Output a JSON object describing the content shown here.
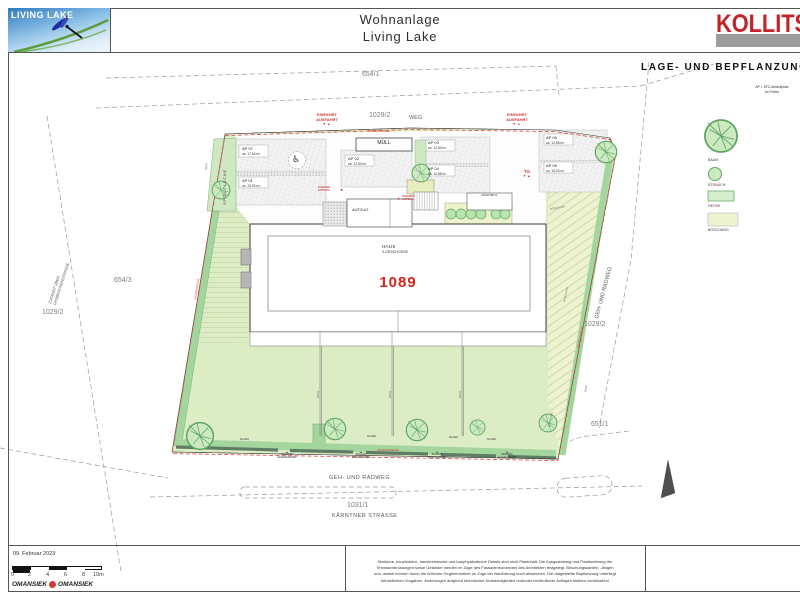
{
  "colors": {
    "accent_red": "#c62127",
    "boundary_red": "#dd4a3c",
    "lawn_green": "#dcedc6",
    "hedge_green": "#a3d69d",
    "boeschung_green": "#edf2cf"
  },
  "header": {
    "logo_text": "LIVING LAKE",
    "title_line1": "Wohnanlage",
    "title_line2": "Living Lake",
    "brand": "KOLLITSCH"
  },
  "side": {
    "plan_title": "LAGE- UND BEPFLANZUNGSPLAN",
    "ap_note_line1": "AP = KFZ-Abstellplatz",
    "ap_note_line2": "im Freien",
    "legend": [
      {
        "label": "BAUM"
      },
      {
        "label": "STRAUCH"
      },
      {
        "label": "HECKE"
      },
      {
        "label": "BÖSCHUNG"
      }
    ]
  },
  "parcels": {
    "top": "654/1",
    "weg_parcel": "1029/2",
    "weg": "WEG",
    "left_mid": "654/3",
    "left_low": "1029/2",
    "right_mid": "1029/2",
    "right_low": "651/1",
    "street_parcel": "1031/1",
    "street_name": "KÄRNTNER STRASSE",
    "radweg": "GEH- UND RADWEG"
  },
  "access": {
    "einfahrt_line1": "EINFAHRT",
    "einfahrt_line2": "AUSFAHRT",
    "tg": "TG",
    "zugang_aufzug_line1": "ZUGANG",
    "zugang_aufzug_line2": "AUFZUG",
    "zugang_garten_line1": "ZUGANG",
    "zugang_garten_line2": "EIGENGARTEN",
    "zufahrt_line1": "ZUFAHRT ÜBER",
    "zufahrt_line2": "GASBRÜCKENSTRASSE"
  },
  "site": {
    "grundgrenze": "GRUNDGRENZE",
    "mauer": "MAUER",
    "zaun": "ZAUN",
    "boeschung": "BÖSCHUNG",
    "spielflaeche": "SPIELFLÄCHE",
    "muell": "MÜLL",
    "aufzug": "AUFZUG",
    "paketbox": "PAKETBOX"
  },
  "building": {
    "name": "HAUS",
    "floors": "3-GESCHOSSE",
    "number": "1089"
  },
  "parking": [
    {
      "name": "AP 07",
      "area": "ca. 17,50 m²"
    },
    {
      "name": "AP 01",
      "area": "ca. 13,00 m²"
    },
    {
      "name": "AP 02",
      "area": "ca. 12,50 m²"
    },
    {
      "name": "AP 03",
      "area": "ca. 12,83 m²"
    },
    {
      "name": "AP 04",
      "area": "ca. 13,88 m²"
    },
    {
      "name": "AP 05",
      "area": "ca. 13,88 m²"
    },
    {
      "name": "AP 06",
      "area": "ca. 15,20 m²"
    }
  ],
  "icons": {
    "wheelchair_icon": "♿",
    "arrow_right_icon": "►",
    "arrow_left_icon": "◄",
    "direction_arrows_icon": "▼▲",
    "gate_marker_icon": "▲"
  },
  "titleblock": {
    "date": "09. Februar 2023",
    "scale_ticks": [
      "0",
      "2",
      "4",
      "6",
      "8",
      "10m"
    ],
    "firm1": "OMANSIEK",
    "firm2": "OMANSIEK",
    "disclaimer_line1": "Statische, konstruktive, haustechnische und bauphysikalische Details sind nicht Planinhalt. Die Ausgestaltung und Positionierung der",
    "disclaimer_line2": "Terrassenbrüstungen sowie Geländer werden im Zuge des Fassadenkonzeptes des Architekten festgelegt. Böschungskanten, -längen",
    "disclaimer_line3": "und -winkel können durch die örtlichen Gegebenheiten im Zuge der Bauführung noch abweichen. Die dargestellte Bepflanzung unterliegt",
    "disclaimer_line4": "behördlichen Vorgaben. Änderungen aufgrund technischer Notwendigkeiten und/oder behördlicher Auflagen bleiben vorbehalten!"
  }
}
